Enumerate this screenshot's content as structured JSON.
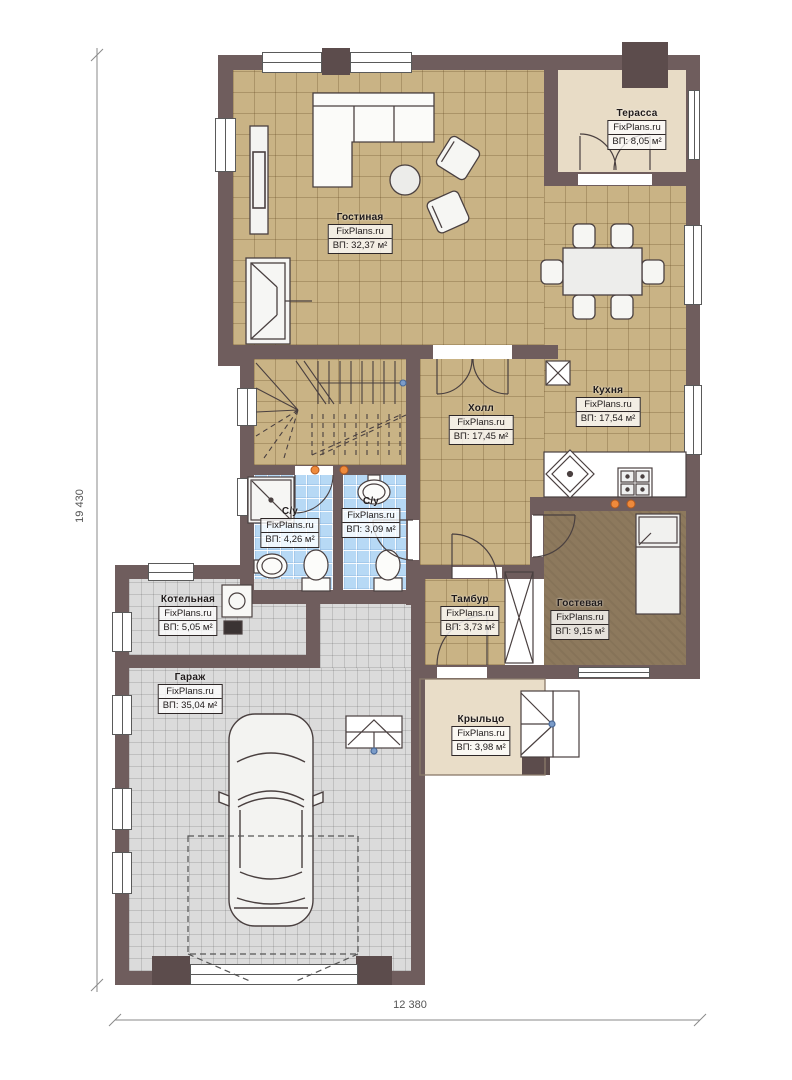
{
  "plan": {
    "brand": "FixPlans.ru",
    "dimensions": {
      "height_label": "19 430",
      "width_label": "12 380"
    },
    "rooms": [
      {
        "id": "terrace",
        "name": "Терасса",
        "brand": "FixPlans.ru",
        "area": "ВП: 8,05 м²"
      },
      {
        "id": "living",
        "name": "Гостиная",
        "brand": "FixPlans.ru",
        "area": "ВП: 32,37 м²"
      },
      {
        "id": "kitchen",
        "name": "Кухня",
        "brand": "FixPlans.ru",
        "area": "ВП: 17,54 м²"
      },
      {
        "id": "hall",
        "name": "Холл",
        "brand": "FixPlans.ru",
        "area": "ВП: 17,45 м²"
      },
      {
        "id": "bath1",
        "name": "С/у",
        "brand": "FixPlans.ru",
        "area": "ВП: 4,26 м²"
      },
      {
        "id": "bath2",
        "name": "С/у",
        "brand": "FixPlans.ru",
        "area": "ВП: 3,09 м²"
      },
      {
        "id": "boiler",
        "name": "Котельная",
        "brand": "FixPlans.ru",
        "area": "ВП: 5,05 м²"
      },
      {
        "id": "garage",
        "name": "Гараж",
        "brand": "FixPlans.ru",
        "area": "ВП: 35,04 м²"
      },
      {
        "id": "vestibule",
        "name": "Тамбур",
        "brand": "FixPlans.ru",
        "area": "ВП: 3,73 м²"
      },
      {
        "id": "guest",
        "name": "Гостевая",
        "brand": "FixPlans.ru",
        "area": "ВП: 9,15 м²"
      },
      {
        "id": "porch",
        "name": "Крыльцо",
        "brand": "FixPlans.ru",
        "area": "ВП: 3,98 м²"
      }
    ],
    "colors": {
      "wall": "#6F5D5D",
      "wall_dark": "#5C4C4C",
      "floor_tan": "#C9B385",
      "floor_terrace": "#E8DCC6",
      "floor_bath": "#B7D9F5",
      "floor_gray": "#DBDBDB",
      "floor_guest": "#8D795D",
      "downlight": "#EE8A3C",
      "line": "#4A4040"
    }
  }
}
